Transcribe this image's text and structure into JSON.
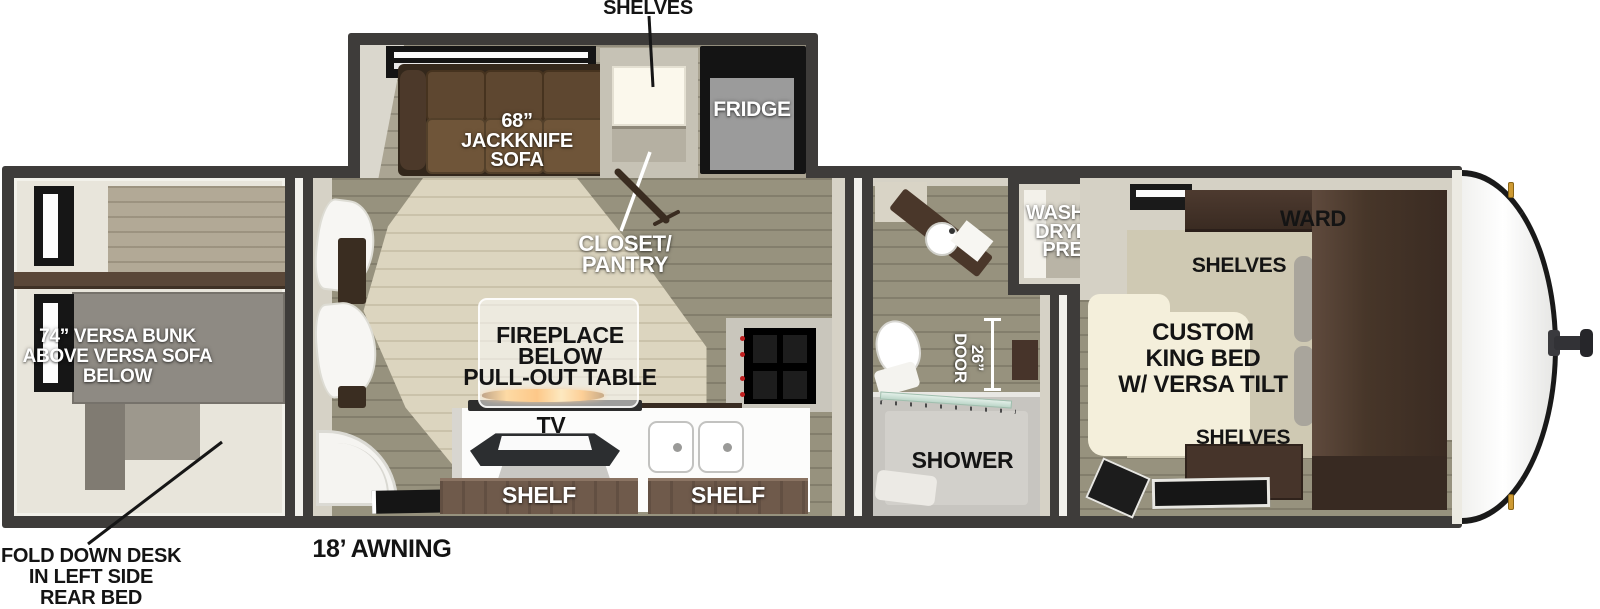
{
  "slide_out": {
    "shelves_callout": "SHELVES",
    "sofa_label_lines": [
      "68”",
      "JACKKNIFE",
      "SOFA"
    ],
    "fridge_label": "FRIDGE"
  },
  "living": {
    "closet_label_lines": [
      "CLOSET/",
      "PANTRY"
    ],
    "fireplace_label_lines": [
      "FIREPLACE",
      "BELOW",
      "PULL-OUT TABLE"
    ],
    "tv_label": "TV",
    "shelf_left_label": "SHELF",
    "shelf_right_label": "SHELF",
    "awning_label": "18’ AWNING"
  },
  "rear_bedroom": {
    "bunk_label_lines": [
      "74” VERSA BUNK",
      "ABOVE VERSA SOFA",
      "BELOW"
    ],
    "desk_callout_lines": [
      "FOLD DOWN DESK",
      "IN LEFT SIDE",
      "REAR BED"
    ]
  },
  "bathroom": {
    "door_label_lines": [
      "26”",
      "DOOR"
    ],
    "shower_label": "SHOWER",
    "washer_label_lines": [
      "WASHER",
      "DRYER",
      "PREP"
    ]
  },
  "front_bedroom": {
    "ward_label": "WARD",
    "shelves_top_label": "SHELVES",
    "bed_label_lines": [
      "CUSTOM",
      "KING BED",
      "W/ VERSA TILT"
    ],
    "shelves_bottom_label": "SHELVES"
  },
  "colors": {
    "wall": "#3e3c3a",
    "trim": "#f2f1ec",
    "cream": "#d6d2c6",
    "floor": "#97927e",
    "tan": "#dcd5bf",
    "wood": "#b2a996",
    "shelfBrown": "#6f5a4b",
    "sofaBrown": "#5e4730",
    "wardrobeBrown": "#45342a",
    "capGold": "#ce9a33",
    "flameOrange": "#ff9a1f",
    "labelWhite": "#ffffff",
    "labelBlack": "#141414"
  }
}
